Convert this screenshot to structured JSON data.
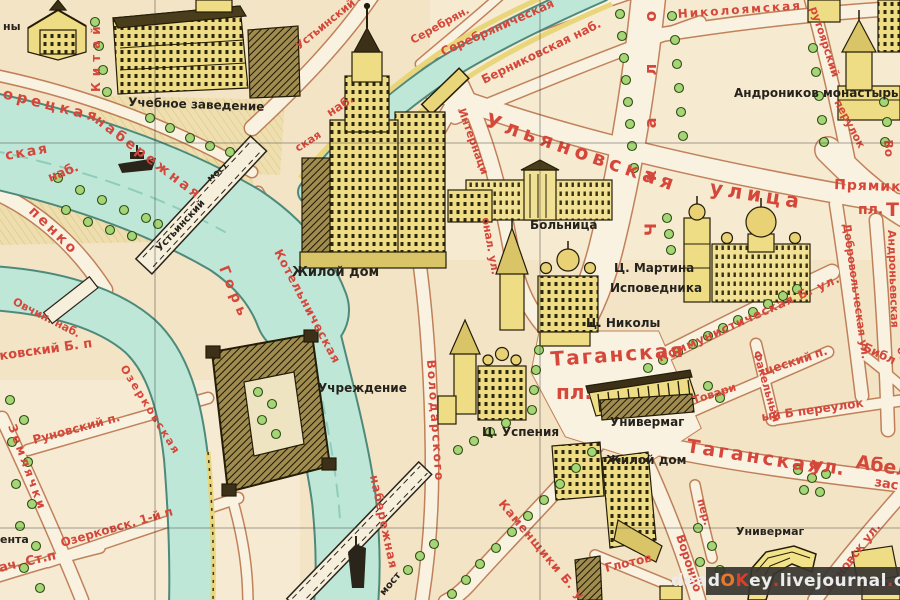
{
  "map": {
    "kind": "vintage illustrated tourist map, Taganka district, Moscow",
    "colors": {
      "paper": "#f3e4c6",
      "street": "#f9f2e0",
      "street_casing": "#b86f47",
      "water": "#bfe7d8",
      "water_edge": "#4d8a7b",
      "building_yellow": "#efdd85",
      "building_line": "#241d07",
      "tree_green": "#a6d577",
      "label_red": "#d4473a",
      "label_black": "#26221c",
      "boulevard_yellow": "#e9d67a"
    },
    "labels": [
      {
        "t": "орецкая",
        "x": 2,
        "y": 98,
        "r": 14,
        "s": 15,
        "c": "r",
        "ls": 4
      },
      {
        "t": "ская",
        "x": 6,
        "y": 160,
        "r": -10,
        "s": 14,
        "c": "r",
        "ls": 2
      },
      {
        "t": "наб.",
        "x": 50,
        "y": 182,
        "r": -22,
        "s": 13,
        "c": "r"
      },
      {
        "t": "набережная",
        "x": 94,
        "y": 122,
        "r": 37,
        "s": 14,
        "c": "r",
        "ls": 3
      },
      {
        "t": "Китай",
        "x": 100,
        "y": 92,
        "r": -90,
        "s": 12,
        "c": "r",
        "ls": 6
      },
      {
        "t": "Устьинский пр.",
        "x": 299,
        "y": 50,
        "r": -39,
        "s": 11,
        "c": "r"
      },
      {
        "t": "Серебрян.",
        "x": 413,
        "y": 44,
        "r": -29,
        "s": 11,
        "c": "r"
      },
      {
        "t": "Серебряническая",
        "x": 443,
        "y": 56,
        "r": -24,
        "s": 12,
        "c": "r"
      },
      {
        "t": "Берниковская наб.",
        "x": 484,
        "y": 84,
        "r": -26,
        "s": 12,
        "c": "r"
      },
      {
        "t": "наб.",
        "x": 330,
        "y": 117,
        "r": -33,
        "s": 12,
        "c": "r"
      },
      {
        "t": "ская",
        "x": 298,
        "y": 152,
        "r": -33,
        "s": 11,
        "c": "r"
      },
      {
        "t": "Николоямская",
        "x": 678,
        "y": 18,
        "r": -4,
        "s": 12,
        "c": "r",
        "ls": 2
      },
      {
        "t": "рутоярский",
        "x": 810,
        "y": 8,
        "r": 72,
        "s": 11,
        "c": "r"
      },
      {
        "t": "перулок",
        "x": 834,
        "y": 102,
        "r": 62,
        "s": 11,
        "c": "r"
      },
      {
        "t": "Чкалова",
        "x": 656,
        "y": 236,
        "r": -90,
        "s": 16,
        "c": "r",
        "ls": 42
      },
      {
        "t": "Ульяновская",
        "x": 484,
        "y": 126,
        "r": 19,
        "s": 20,
        "c": "r",
        "ls": 5
      },
      {
        "t": "улица",
        "x": 709,
        "y": 194,
        "r": 9,
        "s": 20,
        "c": "r",
        "ls": 5
      },
      {
        "t": "Интернаци",
        "x": 458,
        "y": 110,
        "r": 70,
        "s": 11,
        "c": "r"
      },
      {
        "t": "онал. ул.",
        "x": 482,
        "y": 218,
        "r": 80,
        "s": 11,
        "c": "r"
      },
      {
        "t": "Прямико",
        "x": 834,
        "y": 189,
        "r": 2,
        "s": 14,
        "c": "r",
        "ls": 1
      },
      {
        "t": "пл.",
        "x": 858,
        "y": 214,
        "r": 0,
        "s": 14,
        "c": "r"
      },
      {
        "t": "Т",
        "x": 886,
        "y": 216,
        "r": 0,
        "s": 19,
        "c": "r"
      },
      {
        "t": "Таганская",
        "x": 551,
        "y": 366,
        "r": -4,
        "s": 20,
        "c": "r",
        "ls": 2
      },
      {
        "t": "пл.",
        "x": 556,
        "y": 399,
        "r": 0,
        "s": 20,
        "c": "r"
      },
      {
        "t": "Коммунистическая Б. ул.",
        "x": 660,
        "y": 362,
        "r": -24,
        "s": 12,
        "c": "r",
        "ls": 1
      },
      {
        "t": "Добровольческая ул.",
        "x": 843,
        "y": 224,
        "r": 82,
        "s": 11,
        "c": "r"
      },
      {
        "t": "Андроньевская",
        "x": 888,
        "y": 230,
        "r": 88,
        "s": 11,
        "c": "r"
      },
      {
        "t": "больш",
        "x": 897,
        "y": 348,
        "r": 75,
        "s": 11,
        "c": "r"
      },
      {
        "t": "Библ",
        "x": 862,
        "y": 350,
        "r": 25,
        "s": 12,
        "c": "r"
      },
      {
        "t": "Таганская",
        "x": 686,
        "y": 452,
        "r": 9,
        "s": 19,
        "c": "r",
        "ls": 3
      },
      {
        "t": "ул.",
        "x": 810,
        "y": 470,
        "r": 9,
        "s": 19,
        "c": "r"
      },
      {
        "t": "Абел",
        "x": 855,
        "y": 468,
        "r": 9,
        "s": 19,
        "c": "r"
      },
      {
        "t": "зас",
        "x": 874,
        "y": 486,
        "r": 9,
        "s": 13,
        "c": "r"
      },
      {
        "t": "ый Б переулок",
        "x": 762,
        "y": 421,
        "r": -8,
        "s": 12,
        "c": "r"
      },
      {
        "t": "Факельный",
        "x": 753,
        "y": 352,
        "r": 74,
        "s": 11,
        "c": "r"
      },
      {
        "t": "Товари",
        "x": 694,
        "y": 404,
        "r": -18,
        "s": 11,
        "c": "r"
      },
      {
        "t": "щеский",
        "x": 762,
        "y": 376,
        "r": -18,
        "s": 12,
        "c": "r"
      },
      {
        "t": "п.",
        "x": 816,
        "y": 358,
        "r": -18,
        "s": 12,
        "c": "r"
      },
      {
        "t": "пер.",
        "x": 697,
        "y": 500,
        "r": 74,
        "s": 11,
        "c": "r"
      },
      {
        "t": "Воронцо",
        "x": 676,
        "y": 536,
        "r": 72,
        "s": 12,
        "c": "r"
      },
      {
        "t": "Глотов",
        "x": 606,
        "y": 572,
        "r": -13,
        "s": 12,
        "c": "r"
      },
      {
        "t": "мановск ул.",
        "x": 830,
        "y": 592,
        "r": -52,
        "s": 12,
        "c": "r"
      },
      {
        "t": "Котельническая",
        "x": 274,
        "y": 252,
        "r": 62,
        "s": 12,
        "c": "r",
        "ls": 1
      },
      {
        "t": "Горь",
        "x": 219,
        "y": 268,
        "r": 68,
        "s": 14,
        "c": "r",
        "ls": 5
      },
      {
        "t": "набережная",
        "x": 370,
        "y": 476,
        "r": 78,
        "s": 12,
        "c": "r",
        "ls": 1
      },
      {
        "t": "Володарского",
        "x": 427,
        "y": 360,
        "r": 86,
        "s": 12,
        "c": "r",
        "ls": 2
      },
      {
        "t": "Каменщики Б. ул.",
        "x": 498,
        "y": 504,
        "r": 50,
        "s": 12,
        "c": "r",
        "ls": 1
      },
      {
        "t": "Озерковск. 1-й п",
        "x": 62,
        "y": 547,
        "r": -16,
        "s": 12,
        "c": "r"
      },
      {
        "t": "Руновский п.",
        "x": 34,
        "y": 444,
        "r": -15,
        "s": 12,
        "c": "r"
      },
      {
        "t": "Землячки",
        "x": 8,
        "y": 426,
        "r": 70,
        "s": 12,
        "c": "r",
        "ls": 3
      },
      {
        "t": "ач. Ст.п",
        "x": 0,
        "y": 572,
        "r": -13,
        "s": 13,
        "c": "r"
      },
      {
        "t": "Озерковская",
        "x": 120,
        "y": 368,
        "r": 58,
        "s": 11,
        "c": "r",
        "ls": 2
      },
      {
        "t": "Овчин. наб.",
        "x": 12,
        "y": 304,
        "r": 27,
        "s": 11,
        "c": "r"
      },
      {
        "t": "ковский Б. п",
        "x": 0,
        "y": 360,
        "r": -8,
        "s": 13,
        "c": "r"
      },
      {
        "t": "пенко",
        "x": 28,
        "y": 212,
        "r": 44,
        "s": 14,
        "c": "r",
        "ls": 3
      },
      {
        "t": "Во",
        "x": 884,
        "y": 140,
        "r": 85,
        "s": 12,
        "c": "r"
      },
      {
        "t": "ны",
        "x": 3,
        "y": 30,
        "r": 0,
        "s": 11,
        "c": "k"
      },
      {
        "t": "Учебное заведение",
        "x": 128,
        "y": 106,
        "r": 2,
        "s": 12,
        "c": "k"
      },
      {
        "t": "Жилой дом",
        "x": 292,
        "y": 276,
        "r": 0,
        "s": 13,
        "c": "k"
      },
      {
        "t": "Больница",
        "x": 530,
        "y": 229,
        "r": 0,
        "s": 12,
        "c": "k"
      },
      {
        "t": "Ц. Мартина",
        "x": 614,
        "y": 272,
        "r": 0,
        "s": 12,
        "c": "k"
      },
      {
        "t": "Исповедника",
        "x": 610,
        "y": 292,
        "r": 0,
        "s": 12,
        "c": "k"
      },
      {
        "t": "Ц. Николы",
        "x": 586,
        "y": 327,
        "r": 0,
        "s": 12,
        "c": "k"
      },
      {
        "t": "Ц. Успения",
        "x": 482,
        "y": 436,
        "r": 0,
        "s": 12,
        "c": "k"
      },
      {
        "t": "Универмаг",
        "x": 610,
        "y": 426,
        "r": 0,
        "s": 12,
        "c": "k"
      },
      {
        "t": "Жилой дом",
        "x": 606,
        "y": 464,
        "r": 0,
        "s": 12,
        "c": "k"
      },
      {
        "t": "Универмаг",
        "x": 736,
        "y": 535,
        "r": 0,
        "s": 11,
        "c": "k"
      },
      {
        "t": "Андроников монастырь",
        "x": 734,
        "y": 97,
        "r": 0,
        "s": 12,
        "c": "k"
      },
      {
        "t": "Учреждение",
        "x": 318,
        "y": 392,
        "r": 0,
        "s": 12,
        "c": "k"
      },
      {
        "t": "ента",
        "x": 0,
        "y": 543,
        "r": 0,
        "s": 11,
        "c": "k"
      },
      {
        "t": "Устьинский",
        "x": 160,
        "y": 252,
        "r": -47,
        "s": 10,
        "c": "k"
      },
      {
        "t": "мост",
        "x": 210,
        "y": 182,
        "r": -40,
        "s": 9,
        "c": "k"
      },
      {
        "t": "мост",
        "x": 384,
        "y": 596,
        "r": -50,
        "s": 10,
        "c": "k"
      }
    ]
  },
  "watermark": {
    "part1": "dead",
    "part2o": "O",
    "part2k": "K",
    "part3": "ey",
    "dot1": ".",
    "part4": "livejournal",
    "dot2": ".",
    "part5": "com"
  }
}
